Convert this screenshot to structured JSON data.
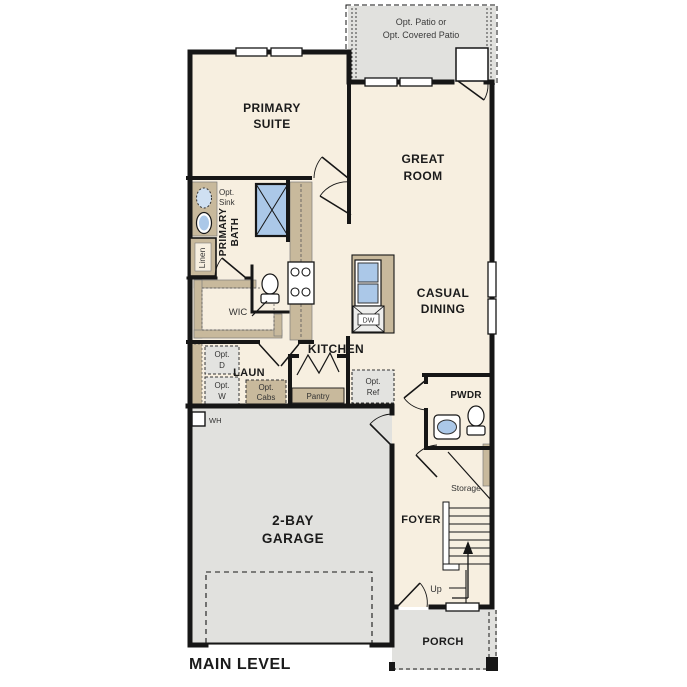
{
  "title": "MAIN LEVEL",
  "colors": {
    "interior": "#f7efe0",
    "exterior_concrete": "#e1e1de",
    "casework_tan": "#c8b99c",
    "fixture_blue": "#abc8e8",
    "wall": "#161616"
  },
  "patio": {
    "line1": "Opt. Patio or",
    "line2": "Opt. Covered Patio"
  },
  "rooms": {
    "primary_suite": {
      "line1": "PRIMARY",
      "line2": "SUITE"
    },
    "great_room": {
      "line1": "GREAT",
      "line2": "ROOM"
    },
    "casual_dining": {
      "line1": "CASUAL",
      "line2": "DINING"
    },
    "kitchen": {
      "label": "KITCHEN"
    },
    "primary_bath": {
      "line1": "PRIMARY",
      "line2": "BATH"
    },
    "wic": {
      "label": "WIC"
    },
    "laundry": {
      "label": "LAUN"
    },
    "powder": {
      "label": "PWDR"
    },
    "foyer": {
      "label": "FOYER"
    },
    "garage": {
      "line1": "2-BAY",
      "line2": "GARAGE"
    },
    "porch": {
      "label": "PORCH"
    }
  },
  "annotations": {
    "opt_sink": {
      "line1": "Opt.",
      "line2": "Sink"
    },
    "linen": "Linen",
    "opt_dryer": {
      "line1": "Opt.",
      "line2": "D"
    },
    "opt_washer": {
      "line1": "Opt.",
      "line2": "W"
    },
    "opt_cabs": {
      "line1": "Opt.",
      "line2": "Cabs"
    },
    "pantry": "Pantry",
    "opt_ref": {
      "line1": "Opt.",
      "line2": "Ref"
    },
    "storage": "Storage",
    "up": "Up",
    "water_heater": "WH",
    "dishwasher": "DW"
  }
}
